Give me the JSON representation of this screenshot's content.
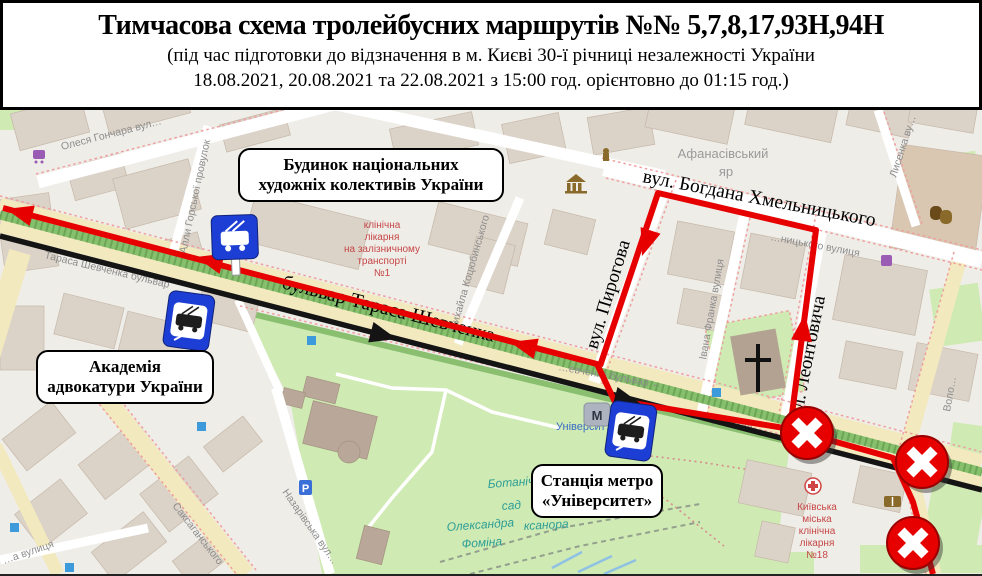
{
  "header": {
    "title": "Тимчасова схема тролейбусних маршрутів №№ 5,7,8,17,93Н,94Н",
    "subtitle1": "(під час підготовки до відзначення в м. Києві 30-ї річниці  незалежності України",
    "subtitle2": "18.08.2021, 20.08.2021 та 22.08.2021 з 15:00 год. орієнтовно до 01:15 год.)"
  },
  "callouts": {
    "building": {
      "line1": "Будинок національних",
      "line2": "художніх колективів України"
    },
    "academy": {
      "line1": "Академія",
      "line2": "адвокатури України"
    },
    "metro": {
      "line1": "Станція метро",
      "line2": "«Університет»"
    }
  },
  "route_annotations": {
    "shevchenka": "бульвар Тараса Шевченка",
    "khmelnytskoho": "вул. Богдана Хмельницького",
    "pyrohova": "вул. Пирогова",
    "leontovycha": "вул. Леонтовича"
  },
  "map": {
    "street_names": {
      "honchara": "Олеся Гончара вул…",
      "horska": "Алли Горської провулок",
      "shevchenka_w": "Тараса Шевченка бульвар",
      "shevchenka_mid": "…евченка бульвар ←",
      "shevchenka_e": "Тараса Ше…",
      "kotsiubynskoho": "Михайла Коцюбинського",
      "franka": "Івана Франка вулиця",
      "khmel_osm": "…ницького вулиця",
      "lysenka": "Лисенка ву…",
      "volodymyrska": "Воло…",
      "saksahanskoho": "Саксаганського",
      "vulytsia": "…а вулиця",
      "nazarivska": "Назарівська вул…",
      "afanasivskyi": "Афанасівський",
      "yar": "яр",
      "universytet": "Університ…"
    },
    "poi": {
      "hospital1": {
        "l1": "клінічна",
        "l2": "лікарня",
        "l3": "на залізничному",
        "l4": "транспорті",
        "l5": "№1"
      },
      "hospital18": {
        "l1": "Київська",
        "l2": "міська",
        "l3": "клінічна",
        "l4": "лікарня",
        "l5": "№18"
      },
      "botanical": {
        "l1": "Ботанічний",
        "l2": "сад",
        "l3": "Олександра",
        "l4": "Фоміна",
        "l5": "ксанора"
      },
      "parking": "P",
      "metro_m": "М"
    }
  },
  "colors": {
    "route_red": "#e60000",
    "route_black": "#141414",
    "closure_red": "#e60000",
    "sign_blue": "#1c3ed4",
    "park_green": "#cfeab3",
    "street_yellow": "#f3e9be",
    "map_base": "#efede8"
  }
}
